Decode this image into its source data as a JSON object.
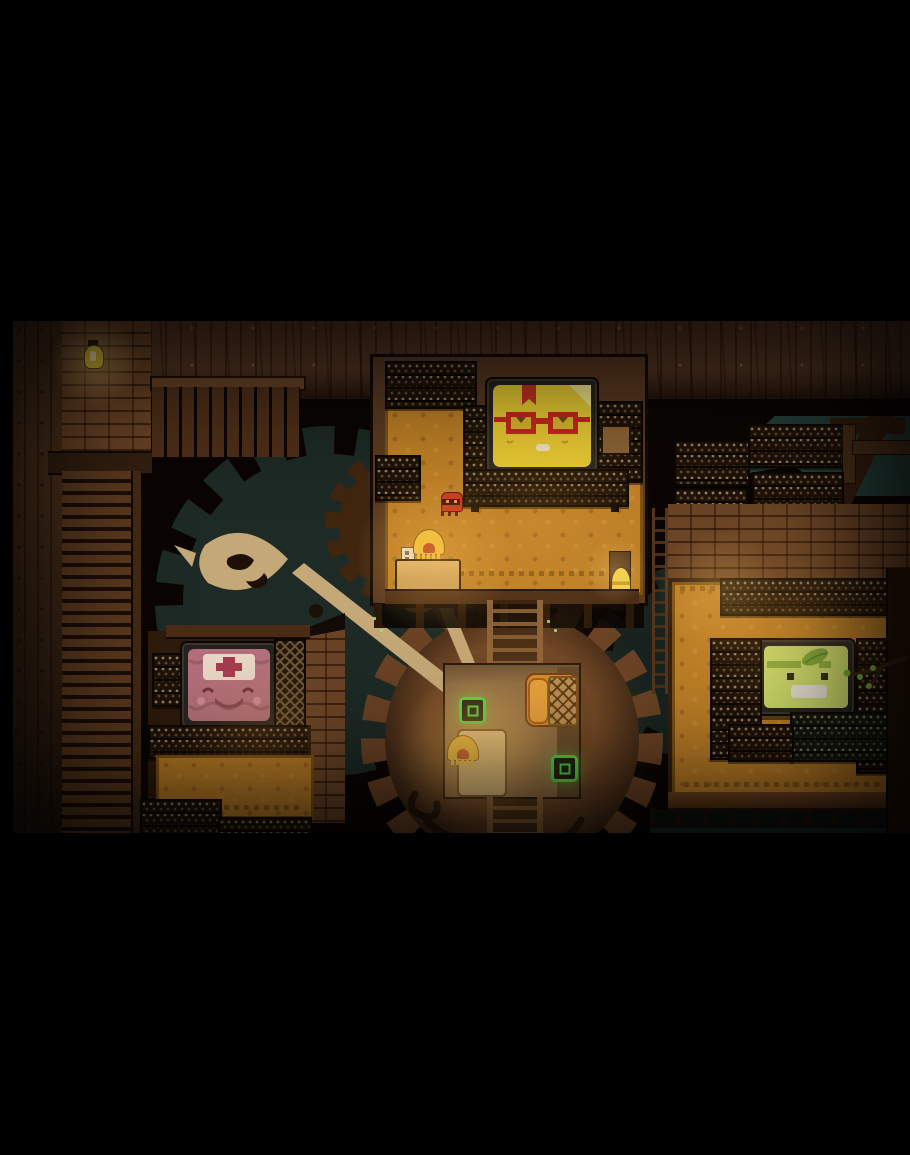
{
  "app": {
    "kind": "pixel-art adventure game screenshot",
    "presentation": "letterboxed 16:9 game view"
  },
  "palette": {
    "letterbox": "#000000",
    "background": "#0a0503",
    "dirt_ceiling": "#573722",
    "wood": "#5b3a20",
    "brick": "#6b4426",
    "carpet": "#bd7f26",
    "gear_teal": "#1d2a25",
    "gear_teal_light": "#26413a",
    "gear_brown": "#6a4224",
    "hand_tan": "#c4a878",
    "hand_dark": "#1d1006",
    "pad_green": "#3ede48",
    "lamp_gold": "#f0c23a",
    "bell_gold": "#f0d24a",
    "glow_warm": "#f2b450",
    "face_yellow": "#e7cb31",
    "ribbon_red": "#c43122",
    "glasses_red": "#c7241a",
    "face_pink": "#b4707c",
    "cap_cream": "#ead9c9",
    "cross_red": "#a73a50",
    "face_green": "#cede6c",
    "leaf_green": "#7cab3a",
    "mouth_white": "#e9e6da",
    "bug_red": "#c23119"
  },
  "scene": {
    "rooms": [
      {
        "id": "top-room",
        "portrait": "yellow book face with red glasses and red bookmark"
      },
      {
        "id": "left-room",
        "portrait": "pink book face with nurse cap and red cross"
      },
      {
        "id": "right-room",
        "portrait": "green book face with leaf on head"
      }
    ],
    "props": [
      "wall lantern",
      "plank fence",
      "slatted stair ladder",
      "giant clock hands",
      "wooden gear",
      "teal gears",
      "bookshelves",
      "hanging shelf racks",
      "orange patterned carpets",
      "fringed desk lamps",
      "writing desks",
      "bed with cross-stitch blanket",
      "two glowing green pads",
      "service bell on post",
      "little red bug",
      "light switch plate",
      "tree branch with leaves",
      "walkway railing"
    ]
  },
  "labels": {
    "lantern": "wall lantern",
    "fence": "plank fence",
    "stairs": "slatted stairs",
    "portrait_glasses": "portrait: book with red glasses",
    "portrait_nurse": "portrait: book with nurse cap",
    "portrait_leaf": "portrait: book with leaf",
    "bug": "little red bug",
    "bell": "service bell",
    "lamp": "fringed desk lamp",
    "desk": "writing desk",
    "bed": "bed",
    "pad": "glowing green pad",
    "ladder": "ladder",
    "gear": "giant gear",
    "clock_hand": "giant clock hand",
    "shelf": "bookshelf",
    "branch": "leafy branch",
    "plate": "switch plate",
    "cabinet": "small cabinet"
  }
}
